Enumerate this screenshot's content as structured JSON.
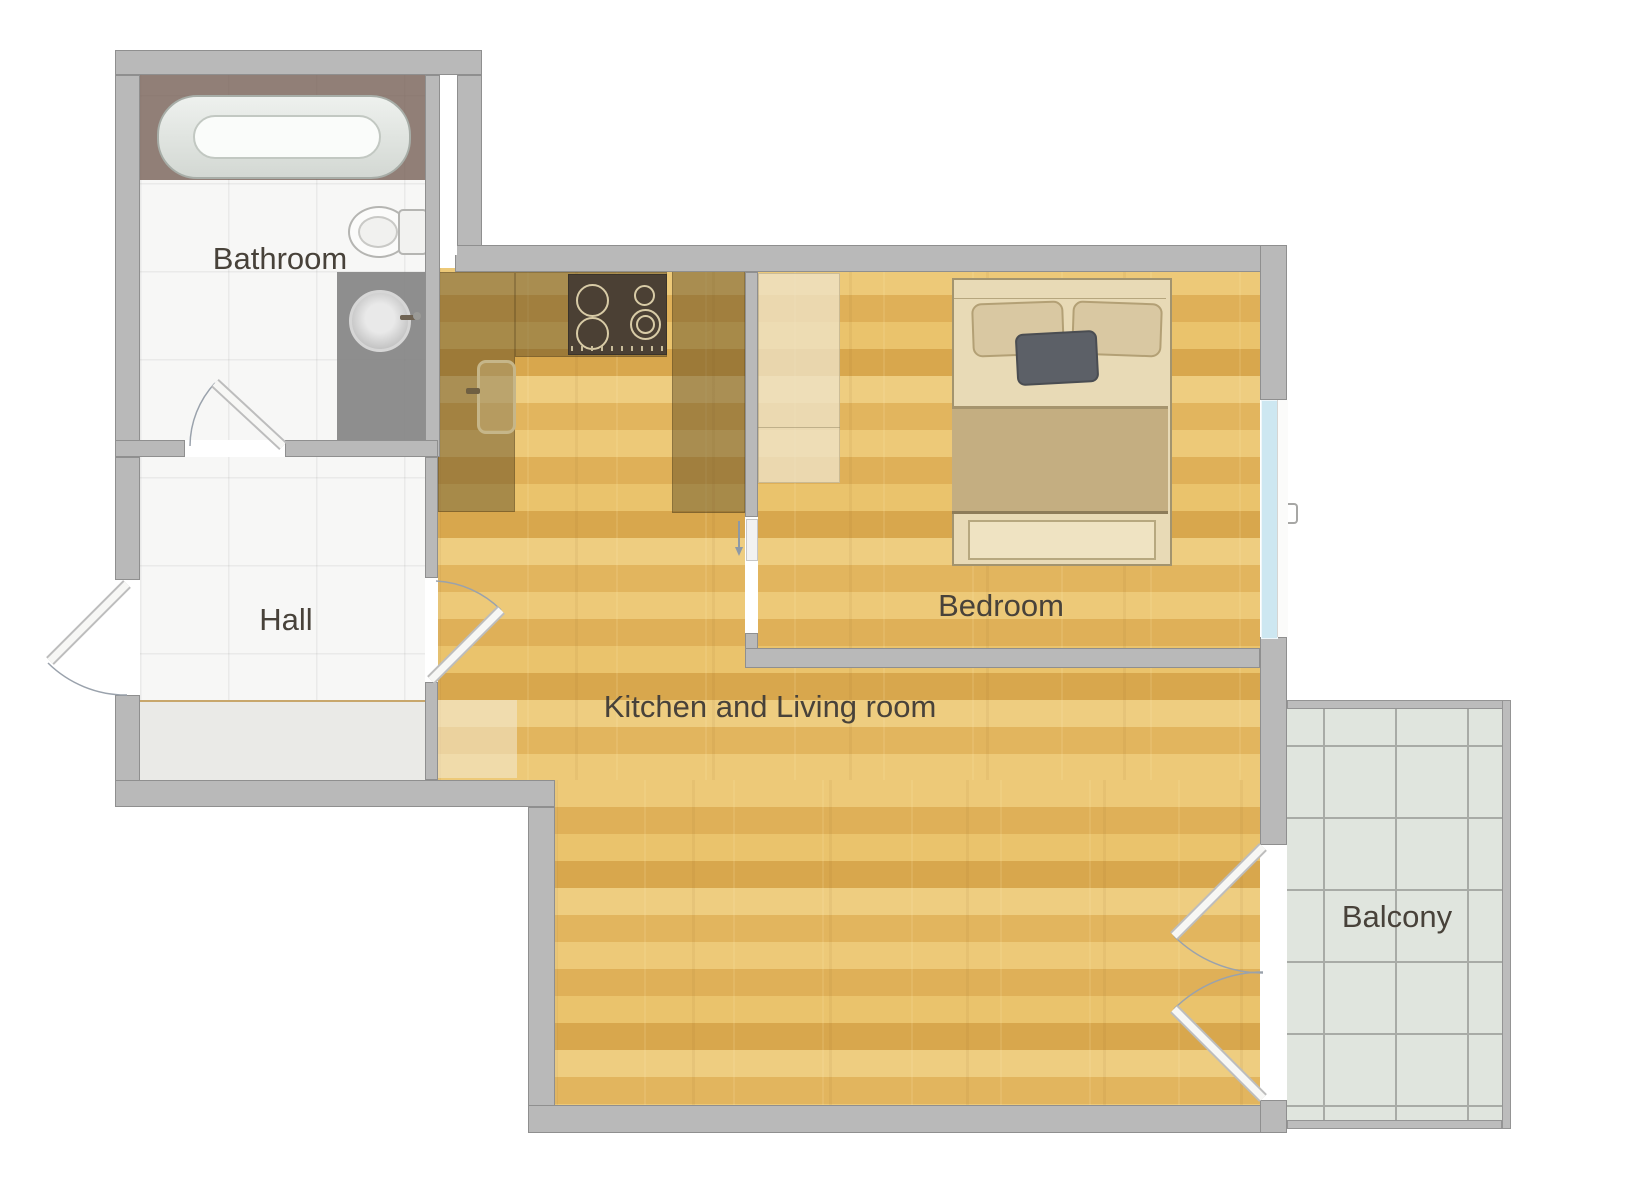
{
  "diagram_type": "apartment-floor-plan",
  "rooms": [
    {
      "id": "bathroom",
      "label": "Bathroom"
    },
    {
      "id": "hall",
      "label": "Hall"
    },
    {
      "id": "kitchen_living",
      "label": "Kitchen and Living room"
    },
    {
      "id": "bedroom",
      "label": "Bedroom"
    },
    {
      "id": "balcony",
      "label": "Balcony"
    }
  ],
  "fixtures": {
    "bathroom": [
      "bathtub",
      "toilet",
      "vanity-counter",
      "round-sink",
      "swing-door"
    ],
    "hall": [
      "entrance-door",
      "floor-mat",
      "door-to-living-room"
    ],
    "kitchen": [
      "l-shaped-countertop",
      "cooktop-4-burners",
      "kitchen-sink"
    ],
    "bedroom": [
      "double-bed",
      "pillows",
      "wardrobe",
      "sliding-door",
      "window"
    ],
    "balcony": [
      "tiled-floor",
      "french-double-doors",
      "railing"
    ]
  },
  "colors": {
    "wall": "#b9b9b9",
    "wall_outline": "#8f8f8f",
    "wood_floor": "#e6bc66",
    "kitchen_counter_overlay": "rgba(87,68,31,0.45)",
    "bathroom_tile": "#f7f7f6",
    "balcony_tile": "#e0e5de",
    "window_glass": "#cde7f1",
    "tub_platform": "#8f7e75",
    "bathroom_counter": "#8e8e8e",
    "cooktop": "#4b4034",
    "dark_pillow": "#5c6067",
    "bed_frame": "#e8dab6",
    "blanket": "#c4ae81",
    "label_text": "#48423a"
  }
}
